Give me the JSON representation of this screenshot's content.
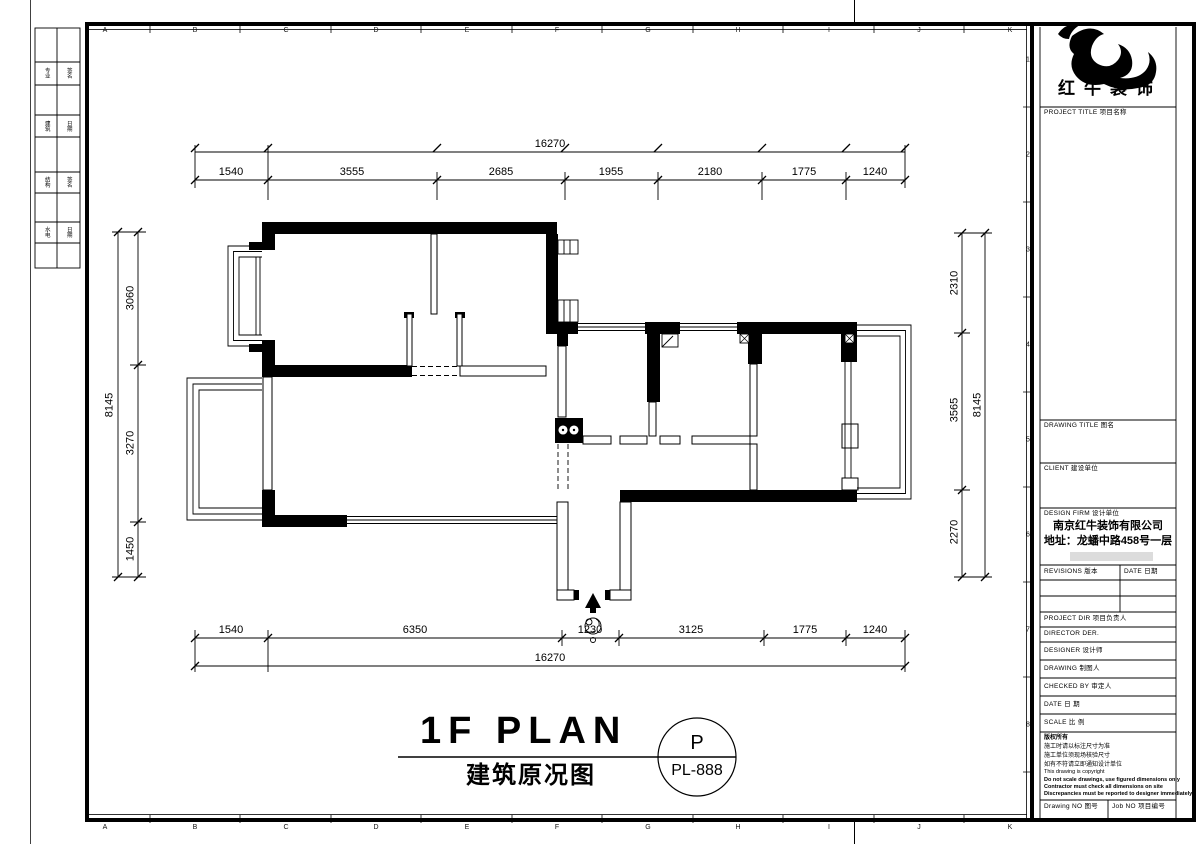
{
  "colors": {
    "ink": "#000000",
    "paper": "#ffffff",
    "muted_bar": "#dcdcdc"
  },
  "frame": {
    "grid_letters": [
      "A",
      "B",
      "C",
      "D",
      "E",
      "F",
      "G",
      "H",
      "I",
      "J",
      "K"
    ],
    "grid_numbers": [
      "1",
      "2",
      "3",
      "4",
      "5",
      "6",
      "7",
      "8"
    ],
    "signoff": [
      {
        "c1": "专业",
        "c2": "签名"
      },
      {
        "c1": "建筑",
        "c2": "日期"
      },
      {
        "c1": "结构",
        "c2": "签名"
      },
      {
        "c1": "水电",
        "c2": "日期"
      }
    ]
  },
  "dimensions": {
    "top": {
      "total": "16270",
      "segments": [
        "1540",
        "3555",
        "2685",
        "1955",
        "2180",
        "1775",
        "1240"
      ]
    },
    "bottom": {
      "total": "16270",
      "segments": [
        "1540",
        "6350",
        "1230",
        "3125",
        "1775",
        "1240"
      ]
    },
    "left": {
      "total": "8145",
      "segments": [
        "3060",
        "3270",
        "1450"
      ]
    },
    "right": {
      "total": "8145",
      "segments": [
        "2310",
        "3565",
        "2270"
      ]
    }
  },
  "title": {
    "main": "1F PLAN",
    "sub": "建筑原况图",
    "stamp_letter": "P",
    "stamp_number": "PL-888"
  },
  "titleblock": {
    "brand": "红牛装饰",
    "project_title": "PROJECT TITLE 项目名称",
    "drawing_title": "DRAWING TITLE 图名",
    "client": "CLIENT 建设单位",
    "design_firm": "DESIGN FIRM 设计单位",
    "firm_name": "南京红牛装饰有限公司",
    "firm_addr": "地址：龙蟠中路458号一层",
    "revisions": "REVISIONS 版本",
    "date_col": "DATE 日期",
    "rows": [
      "PROJECT DIR  项目负责人",
      "DIRECTOR DER.",
      "DESIGNER  设计师",
      "DRAWING  制图人",
      "CHECKED BY  审定人",
      "DATE  日 期",
      "SCALE  比 例"
    ],
    "notes": [
      "版权所有",
      "施工时请以标注尺寸为准",
      "施工单位须现场核验尺寸",
      "如有不符请立即通知设计单位",
      "This drawing is copyright",
      "Do not scale drawings, use figured dimensions only",
      "Contractor must check all dimensions on site",
      "Discrepancies must be reported to designer immediately"
    ],
    "drawing_no": "Drawing NO 图号",
    "job_no": "Job NO 项目编号"
  }
}
